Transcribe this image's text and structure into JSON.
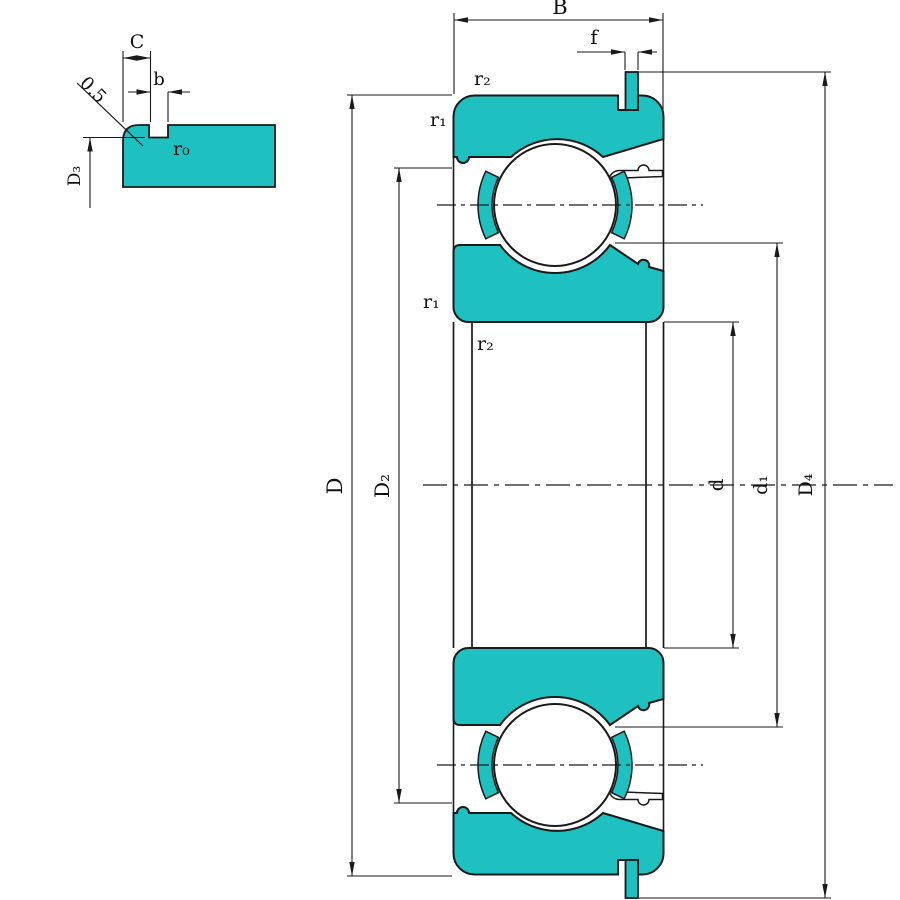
{
  "colors": {
    "fill_teal": "#1ec0c0",
    "line": "#1a1a1a",
    "background": "#ffffff"
  },
  "detail_view": {
    "dim_C": "C",
    "dim_b": "b",
    "chamfer": "0.5",
    "radius_r0": "r₀",
    "dim_D3": "D₃"
  },
  "main_view": {
    "dim_B": "B",
    "dim_f": "f",
    "r2_top": "r₂",
    "r1_top": "r₁",
    "r1_mid": "r₁",
    "r2_bore": "r₂",
    "dim_D": "D",
    "dim_D2": "D₂",
    "dim_d": "d",
    "dim_d1": "d₁",
    "dim_D4": "D₄"
  }
}
